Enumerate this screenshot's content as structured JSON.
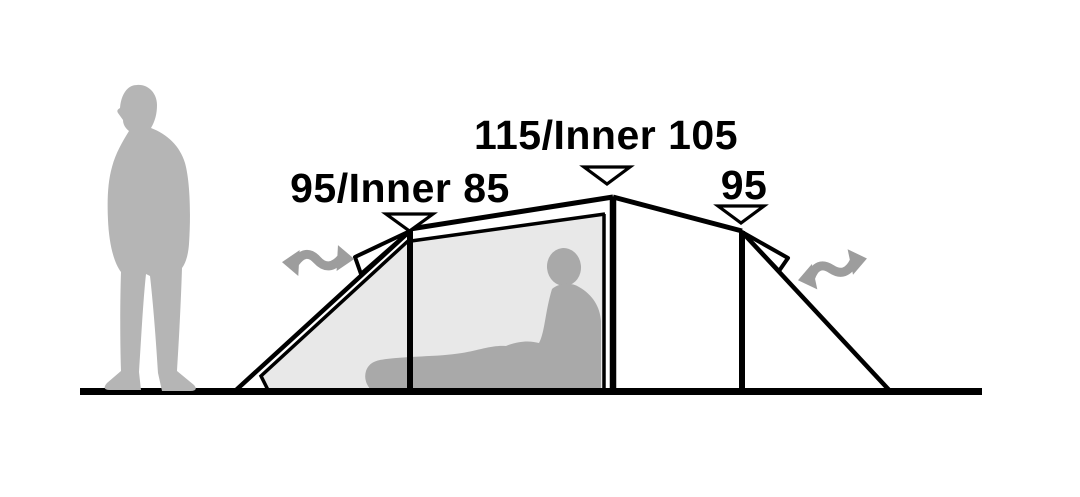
{
  "diagram": {
    "description": "Tent side-profile dimension diagram with standing person for scale and sitting person inside the inner tent",
    "measurements": {
      "left": {
        "label": "95/Inner 85",
        "outer": "95",
        "inner": "85"
      },
      "center": {
        "label": "115/Inner 105",
        "outer": "115",
        "inner": "105"
      },
      "right": {
        "label": "95",
        "outer": "95"
      }
    },
    "colors": {
      "outline": "#000000",
      "background": "#ffffff",
      "standing_person": "#b5b5b5",
      "sitting_person": "#a9a9a9",
      "inner_tent_panel": "#e8e8e8",
      "airflow_arrow": "#9d9d9d"
    },
    "icons": {
      "marker": "down-triangle-icon",
      "airflow": "airflow-arrow-icon"
    }
  }
}
